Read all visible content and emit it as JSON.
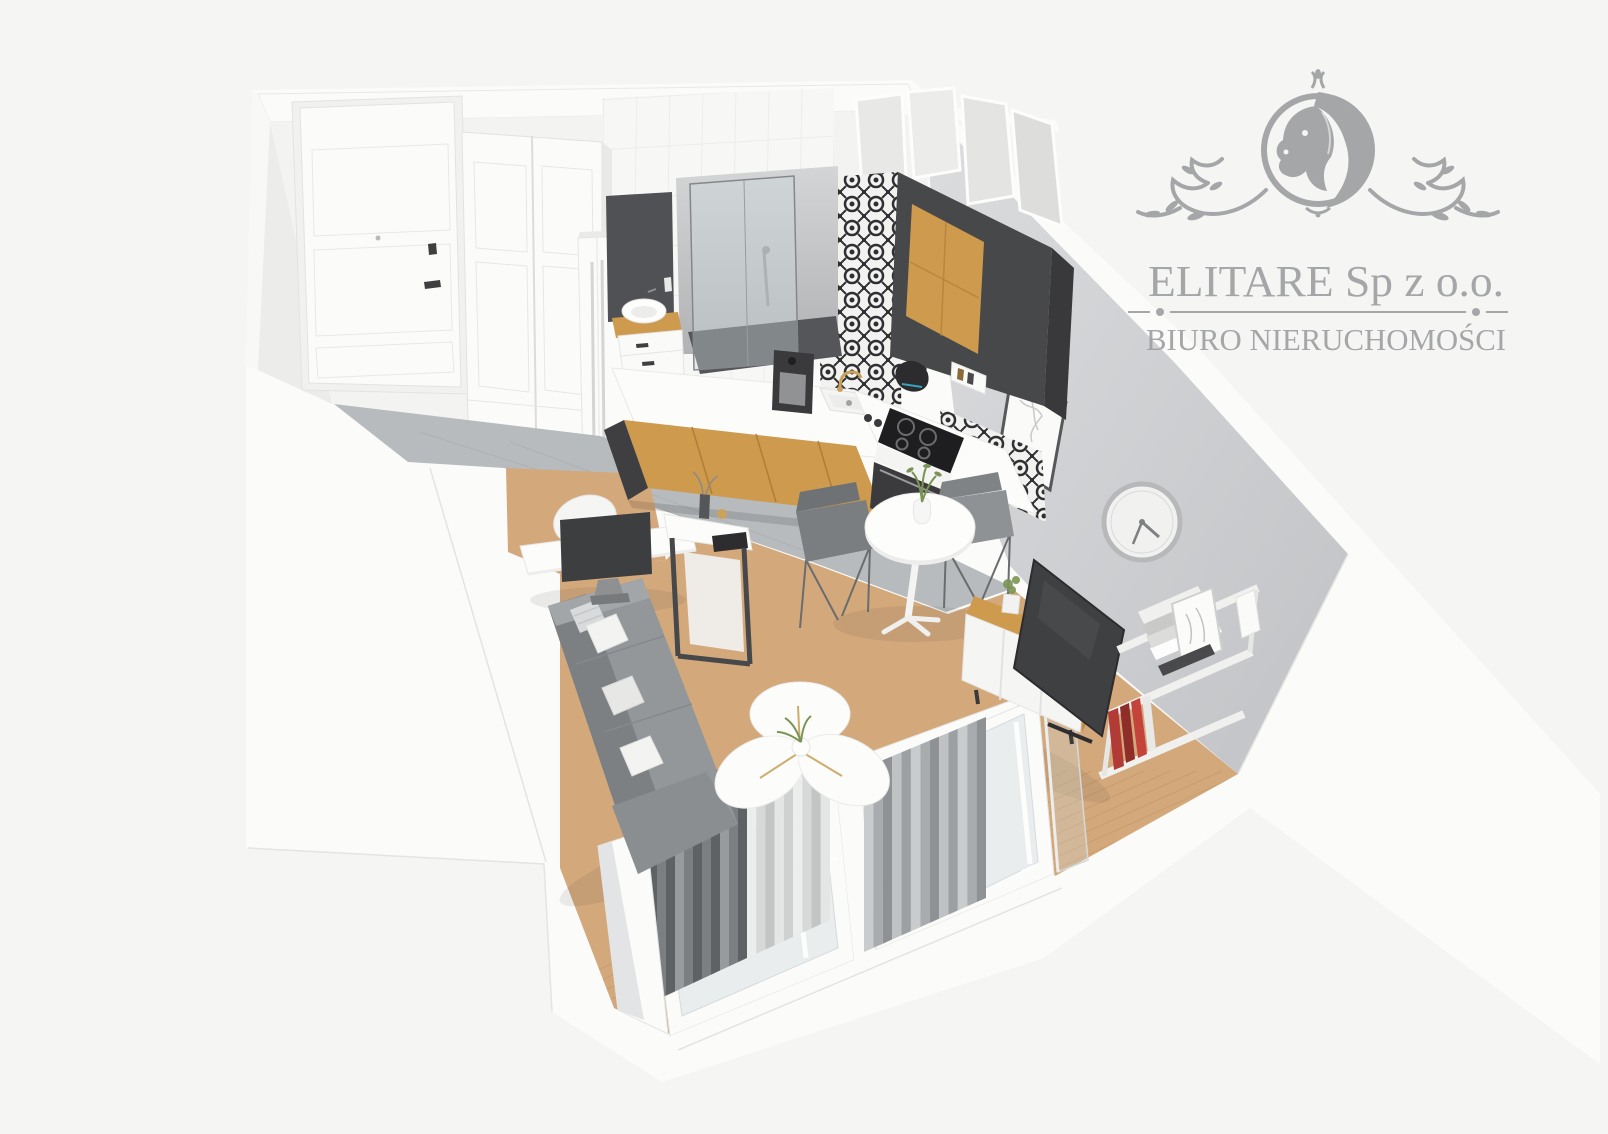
{
  "watermark": {
    "company": "ELITARE Sp z o.o.",
    "tagline": "BIURO NIERUCHOMOŚCI"
  },
  "scene": {
    "kind": "3d-floorplan-render",
    "areas": [
      "hallway",
      "bathroom",
      "kitchen",
      "dining-area",
      "living-area",
      "balcony-windows"
    ]
  },
  "palette": {
    "background": "#f5f5f4",
    "wall_white": "#fbfbfa",
    "wall_face": "#f3f3f2",
    "wall_edge": "#e4e4e2",
    "wall_gray_light": "#d9dadc",
    "wall_gray_dark": "#c3c5c8",
    "floor_gray": "#b8bbbd",
    "floor_wood": "#d3a97c",
    "wood_line": "#c0935f",
    "cabinet_wood": "#cd9a4e",
    "dark_panel": "#47484a",
    "sofa_gray": "#94979a",
    "sofa_dark": "#7d8083",
    "curtain_dark": "#5f6265",
    "curtain_light": "#e9eaea",
    "curtain_gray": "#a9acae",
    "logo_gray": "#9ea0a2",
    "gold": "#c9a35c",
    "plant_green": "#7b9455",
    "hob_black": "#1e1e20",
    "red_book": "#b23b35"
  }
}
